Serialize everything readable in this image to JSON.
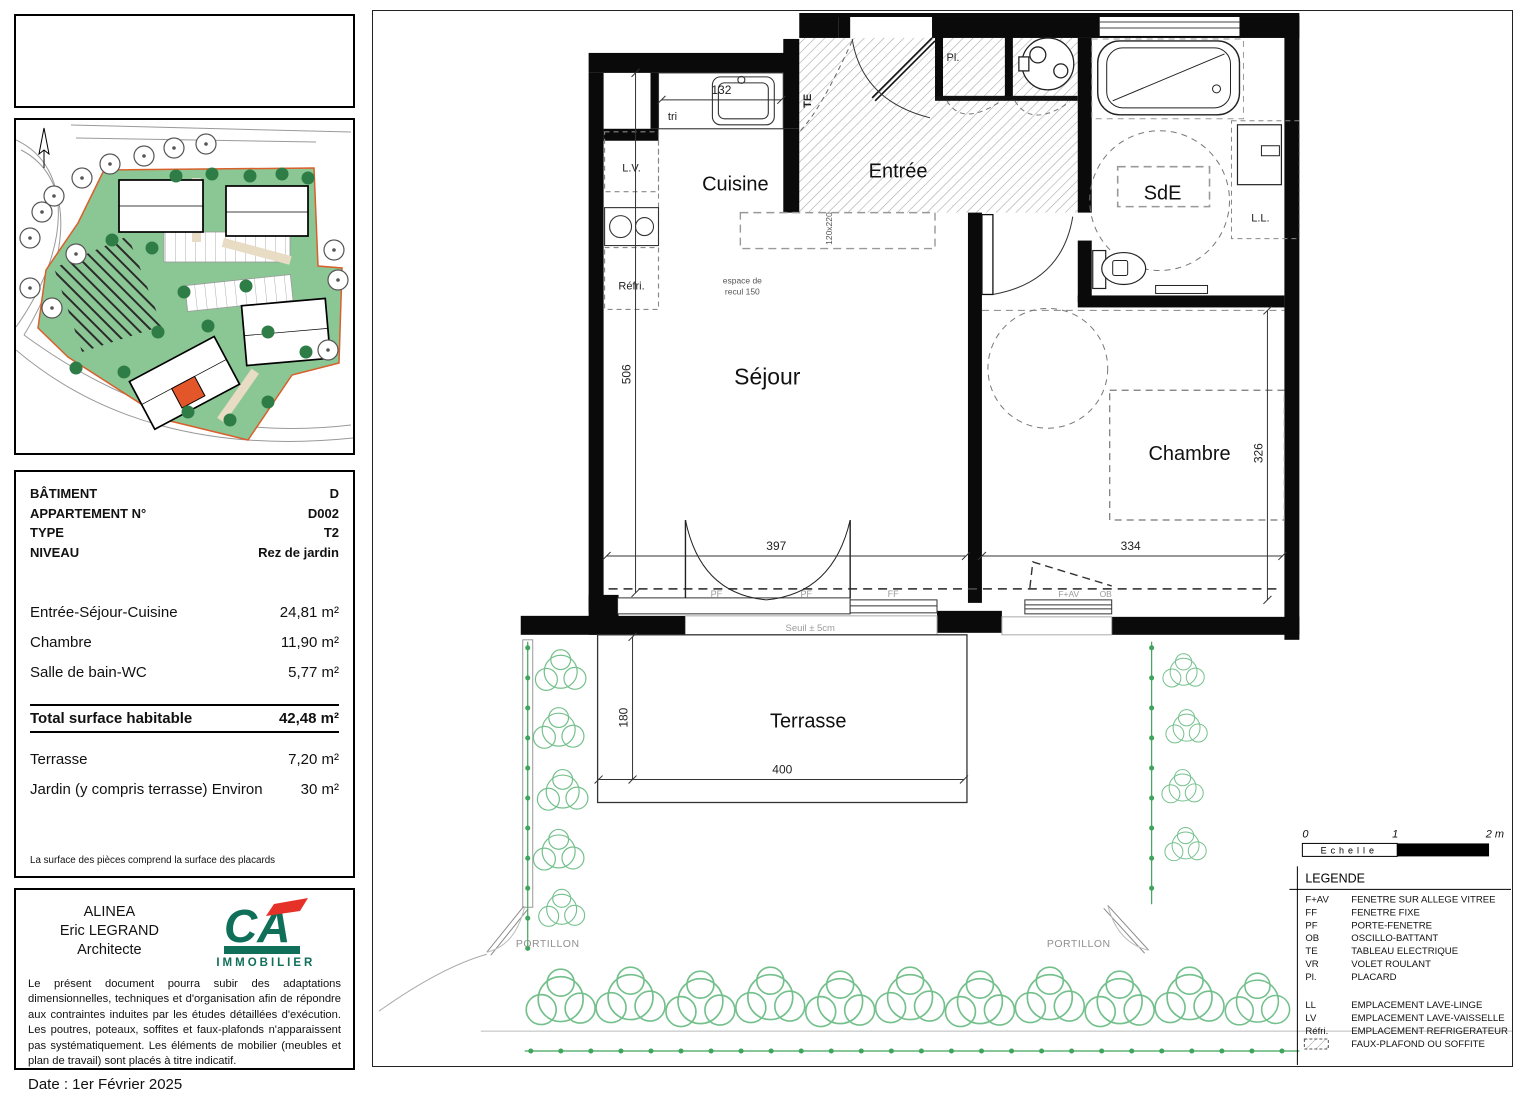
{
  "colors": {
    "teal": "#2d8c7b",
    "ca_green": "#0f6f58",
    "ca_red": "#e63128",
    "site_green": "#8bc795",
    "tree_green": "#2f7d46",
    "hedge_green": "#74c08c",
    "unit_red": "#e2562a"
  },
  "logo": {
    "title": "Kuzh-Heol"
  },
  "info_box": {
    "rows": [
      {
        "label": "BÂTIMENT",
        "value": "D"
      },
      {
        "label": "APPARTEMENT N°",
        "value": "D002"
      },
      {
        "label": "TYPE",
        "value": "T2"
      },
      {
        "label": "NIVEAU",
        "value": "Rez de jardin"
      }
    ]
  },
  "surfaces": {
    "rows": [
      {
        "label": "Entrée-Séjour-Cuisine",
        "value": "24,81 m²"
      },
      {
        "label": "Chambre",
        "value": "11,90 m²"
      },
      {
        "label": "Salle de bain-WC",
        "value": "5,77 m²"
      }
    ],
    "total": {
      "label": "Total surface habitable",
      "value": "42,48 m²"
    },
    "outdoor": [
      {
        "label": "Terrasse",
        "value": "7,20 m²"
      },
      {
        "label": "Jardin (y compris terrasse) Environ",
        "value": "30 m²"
      }
    ],
    "note": "La surface des pièces comprend la surface des placards"
  },
  "architect": {
    "line1": "ALINEA",
    "line2": "Eric LEGRAND",
    "line3": "Architecte",
    "brand": "IMMOBILIER",
    "disclaimer": "Le présent document pourra subir des adaptations dimensionnelles, techniques et d'organisation afin de répondre aux contraintes induites par les études détaillées d'exécution. Les poutres, poteaux, soffites et faux-plafonds n'apparaissent pas systématiquement. Les éléments de mobilier (meubles et plan de travail) sont placés à titre indicatif.",
    "date": "Date : 1er Février 2025"
  },
  "plan": {
    "rooms": {
      "cuisine": "Cuisine",
      "entree": "Entrée",
      "sde": "SdE",
      "sejour": "Séjour",
      "chambre": "Chambre",
      "terrasse": "Terrasse"
    },
    "annotations": {
      "tri": "tri",
      "te": "TE",
      "lv": "L.V.",
      "refri": "Réfri.",
      "recul1": "espace de",
      "recul2": "recul 150",
      "dim120": "120x220",
      "pl": "Pl.",
      "ll": "L.L.",
      "seuil": "Seuil ± 5cm",
      "pf": "PF",
      "ff": "FF",
      "fav": "F+AV",
      "ob": "OB",
      "portillon": "PORTILLON"
    },
    "dims": {
      "d132": "132",
      "d506": "506",
      "d397": "397",
      "d334": "334",
      "d326": "326",
      "d180": "180",
      "d400": "400"
    }
  },
  "scalebar": {
    "t0": "0",
    "t1": "1",
    "t2": "2 m",
    "label": "Echelle"
  },
  "legend": {
    "title": "LEGENDE",
    "items": [
      {
        "abbr": "F+AV",
        "label": "FENETRE SUR ALLEGE VITREE"
      },
      {
        "abbr": "FF",
        "label": "FENETRE FIXE"
      },
      {
        "abbr": "PF",
        "label": "PORTE-FENETRE"
      },
      {
        "abbr": "OB",
        "label": "OSCILLO-BATTANT"
      },
      {
        "abbr": "TE",
        "label": "TABLEAU ELECTRIQUE"
      },
      {
        "abbr": "VR",
        "label": "VOLET ROULANT"
      },
      {
        "abbr": "Pl.",
        "label": "PLACARD"
      }
    ],
    "items2": [
      {
        "abbr": "LL",
        "label": "EMPLACEMENT LAVE-LINGE"
      },
      {
        "abbr": "LV",
        "label": "EMPLACEMENT LAVE-VAISSELLE"
      },
      {
        "abbr": "Réfri.",
        "label": "EMPLACEMENT REFRIGERATEUR"
      },
      {
        "abbr": "",
        "label": "FAUX-PLAFOND OU SOFFITE"
      }
    ]
  }
}
